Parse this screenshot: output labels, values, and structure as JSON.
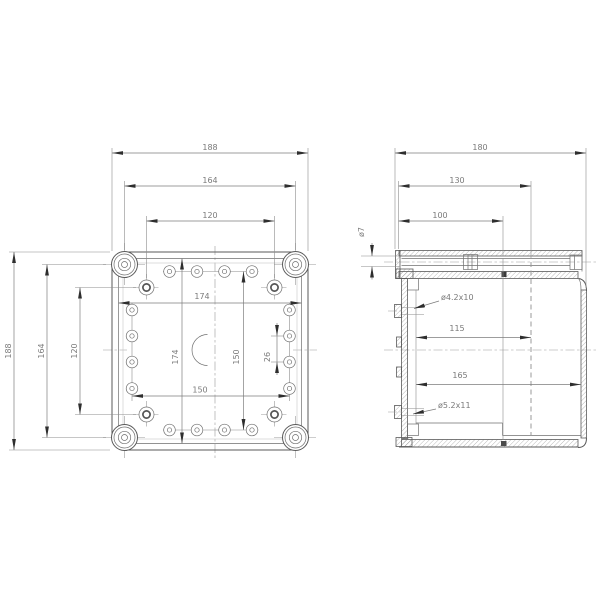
{
  "colors": {
    "background": "#ffffff",
    "line": "#5a5a5a",
    "dimension_text": "#7a7a7a"
  },
  "front_view": {
    "top_dims": {
      "outer": "188",
      "corner_screws": "164",
      "inner_screws": "120"
    },
    "left_dims": {
      "outer": "188",
      "corner_screws": "164",
      "inner_screws": "120"
    },
    "inner_dims": {
      "lid_width": "174",
      "lid_height": "174",
      "knockout_col_span": "150",
      "knockout_row_span": "150",
      "knockout_pitch": "26"
    }
  },
  "side_view": {
    "top_dims": {
      "outer": "180",
      "lid": "130",
      "base": "100"
    },
    "inner_dims": {
      "depth_a": "115",
      "depth_b": "165"
    },
    "callouts": {
      "cover_screw": "ø7",
      "hole_upper": "ø4.2x10",
      "hole_lower": "ø5.2x11"
    }
  }
}
